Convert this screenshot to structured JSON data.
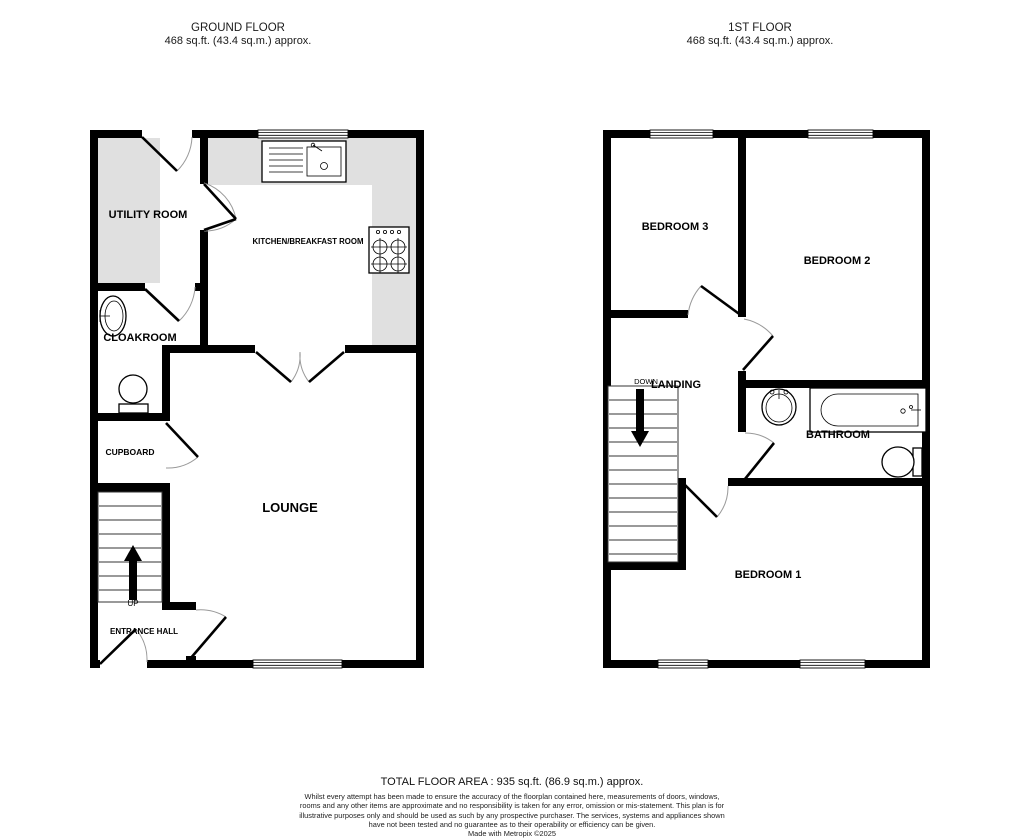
{
  "ground": {
    "title": "GROUND FLOOR",
    "area": "468 sq.ft. (43.4 sq.m.) approx.",
    "rooms": {
      "utility": "UTILITY ROOM",
      "kitchen": "KITCHEN/BREAKFAST ROOM",
      "cloakroom": "CLOAKROOM",
      "cupboard": "CUPBOARD",
      "lounge": "LOUNGE",
      "entrance_hall": "ENTRANCE HALL"
    },
    "stair_direction": "UP"
  },
  "first": {
    "title": "1ST FLOOR",
    "area": "468 sq.ft. (43.4 sq.m.) approx.",
    "rooms": {
      "bedroom3": "BEDROOM 3",
      "bedroom2": "BEDROOM 2",
      "landing": "LANDING",
      "bathroom": "BATHROOM",
      "bedroom1": "BEDROOM 1"
    },
    "stair_direction": "DOWN"
  },
  "footer": {
    "total_area": "TOTAL FLOOR AREA : 935 sq.ft. (86.9 sq.m.) approx.",
    "disclaimer": "Whilst every attempt has been made to ensure the accuracy of the floorplan contained here, measurements of doors, windows, rooms and any other items are approximate and no responsibility is taken for any error, omission or mis-statement. This plan is for illustrative purposes only and should be used as such by any prospective purchaser. The services, systems and appliances shown have not been tested and no guarantee as to their operability or efficiency can be given.",
    "credit": "Made with Metropix ©2025"
  },
  "colors": {
    "wall": "#000000",
    "counter": "#e0e0e0",
    "background": "#ffffff"
  }
}
